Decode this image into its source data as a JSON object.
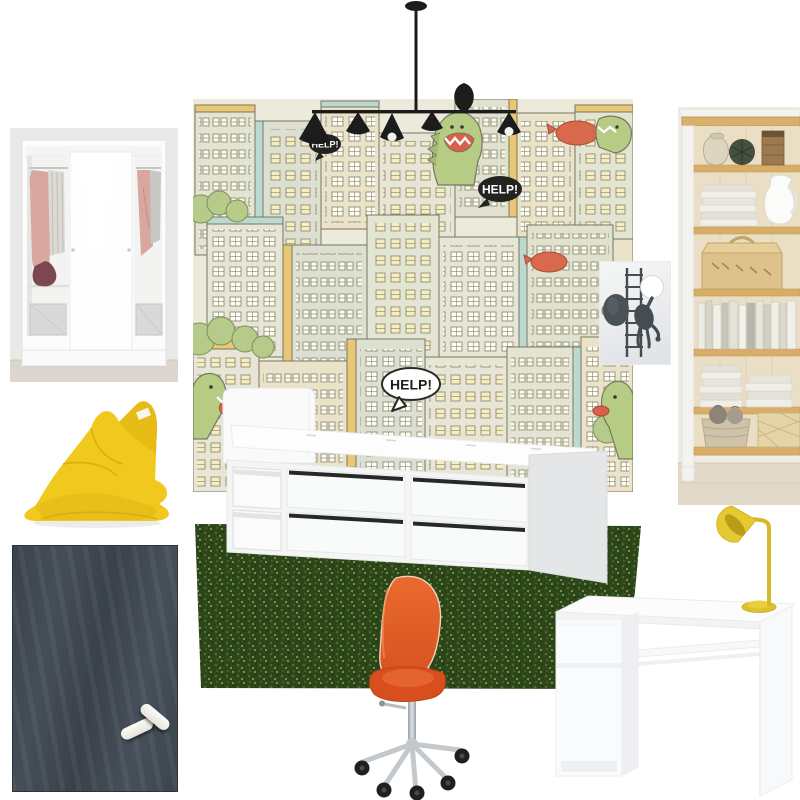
{
  "board": {
    "background": "#ffffff"
  },
  "wallpaper": {
    "bubbles": [
      {
        "text": "HELP!",
        "variant": "dark-small"
      },
      {
        "text": "HELP!",
        "variant": "dark-large"
      },
      {
        "text": "HELP!",
        "variant": "light-large"
      }
    ]
  },
  "palette": {
    "beanbag_yellow": "#f1c81e",
    "chair_orange": "#e05a28",
    "rug_green": "#2c451b",
    "lamp_yellow": "#ddc22e",
    "pendant_black": "#1c1c1c",
    "chalkboard_slate": "#3b434b",
    "wallpaper_cream": "#e7e6d6",
    "wallpaper_accent_yellow": "#e9c775",
    "wallpaper_accent_teal": "#bcd9d1",
    "dino_green": "#b6cc85",
    "blimp_red": "#d9694d"
  },
  "items": [
    {
      "name": "monster-city-wallpaper"
    },
    {
      "name": "linear-pendant-light"
    },
    {
      "name": "sliding-door-wardrobe"
    },
    {
      "name": "yellow-beanbag"
    },
    {
      "name": "chalkboard"
    },
    {
      "name": "white-storage-bed"
    },
    {
      "name": "grass-rug"
    },
    {
      "name": "orange-desk-chair"
    },
    {
      "name": "wooden-bookshelf"
    },
    {
      "name": "climbing-man-wall-sconce"
    },
    {
      "name": "white-desk"
    },
    {
      "name": "yellow-desk-lamp"
    }
  ]
}
